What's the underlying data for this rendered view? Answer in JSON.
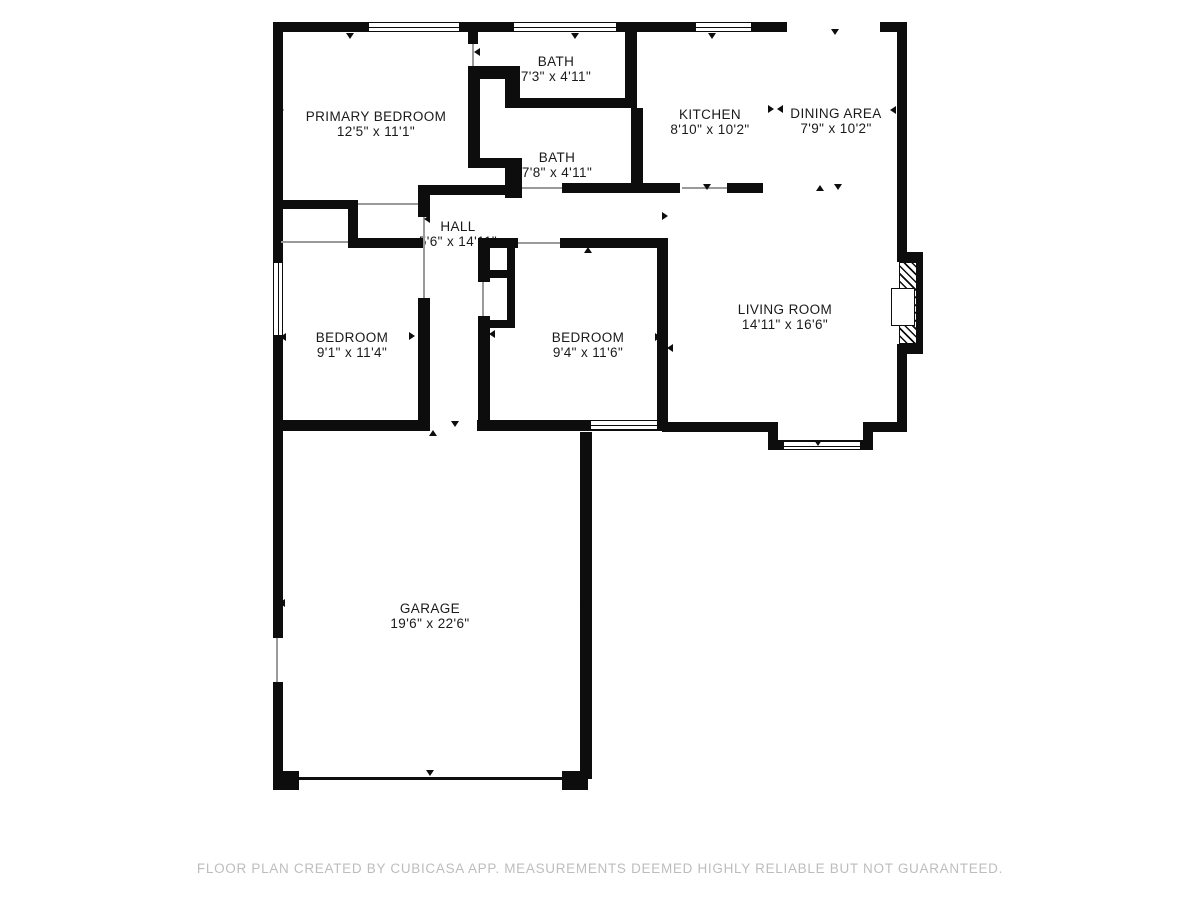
{
  "footer": {
    "text": "FLOOR PLAN CREATED BY CUBICASA APP. MEASUREMENTS DEEMED HIGHLY RELIABLE BUT NOT GUARANTEED.",
    "color": "#bdbdbd"
  },
  "floorplan": {
    "wall_color": "#0d0d0d",
    "rooms": [
      {
        "id": "primary-bedroom",
        "name": "PRIMARY BEDROOM",
        "dims": "12'5\" x 11'1\"",
        "cx": 376,
        "cy": 124
      },
      {
        "id": "bath-top",
        "name": "BATH",
        "dims": "7'3\" x 4'11\"",
        "cx": 556,
        "cy": 69
      },
      {
        "id": "bath",
        "name": "BATH",
        "dims": "7'8\" x 4'11\"",
        "cx": 557,
        "cy": 165
      },
      {
        "id": "kitchen",
        "name": "KITCHEN",
        "dims": "8'10\" x 10'2\"",
        "cx": 710,
        "cy": 122
      },
      {
        "id": "dining-area",
        "name": "DINING AREA",
        "dims": "7'9\" x 10'2\"",
        "cx": 836,
        "cy": 121
      },
      {
        "id": "hall",
        "name": "HALL",
        "dims": "5'6\" x 14'11\"",
        "cx": 458,
        "cy": 234
      },
      {
        "id": "bedroom-left",
        "name": "BEDROOM",
        "dims": "9'1\" x 11'4\"",
        "cx": 352,
        "cy": 345
      },
      {
        "id": "bedroom-middle",
        "name": "BEDROOM",
        "dims": "9'4\" x 11'6\"",
        "cx": 588,
        "cy": 345
      },
      {
        "id": "living-room",
        "name": "LIVING ROOM",
        "dims": "14'11\" x 16'6\"",
        "cx": 785,
        "cy": 317
      },
      {
        "id": "garage",
        "name": "GARAGE",
        "dims": "19'6\" x 22'6\"",
        "cx": 430,
        "cy": 616
      }
    ],
    "walls": [
      [
        273,
        22,
        514,
        10
      ],
      [
        880,
        22,
        27,
        10
      ],
      [
        897,
        22,
        10,
        240
      ],
      [
        897,
        347,
        10,
        85
      ],
      [
        273,
        22,
        10,
        616
      ],
      [
        273,
        682,
        10,
        95
      ],
      [
        273,
        771,
        26,
        19
      ],
      [
        562,
        771,
        26,
        19
      ],
      [
        283,
        777,
        281,
        3
      ],
      [
        580,
        432,
        12,
        347
      ],
      [
        283,
        420,
        147,
        11
      ],
      [
        477,
        420,
        115,
        11
      ],
      [
        580,
        420,
        88,
        11
      ],
      [
        662,
        422,
        116,
        10
      ],
      [
        768,
        422,
        10,
        28
      ],
      [
        778,
        440,
        95,
        10
      ],
      [
        863,
        422,
        10,
        28
      ],
      [
        873,
        422,
        34,
        10
      ],
      [
        897,
        252,
        26,
        10
      ],
      [
        897,
        344,
        26,
        10
      ],
      [
        915,
        252,
        8,
        102
      ],
      [
        468,
        32,
        10,
        12
      ],
      [
        468,
        66,
        50,
        13
      ],
      [
        505,
        66,
        15,
        42
      ],
      [
        505,
        98,
        125,
        10
      ],
      [
        468,
        76,
        12,
        92
      ],
      [
        468,
        158,
        50,
        10
      ],
      [
        505,
        158,
        17,
        40
      ],
      [
        625,
        32,
        12,
        76
      ],
      [
        631,
        108,
        12,
        80
      ],
      [
        562,
        183,
        118,
        10
      ],
      [
        727,
        183,
        36,
        10
      ],
      [
        428,
        185,
        94,
        10
      ],
      [
        283,
        200,
        70,
        9
      ],
      [
        348,
        200,
        10,
        48
      ],
      [
        348,
        238,
        75,
        10
      ],
      [
        418,
        185,
        12,
        32
      ],
      [
        418,
        298,
        12,
        127
      ],
      [
        478,
        238,
        40,
        10
      ],
      [
        560,
        238,
        107,
        10
      ],
      [
        657,
        238,
        11,
        190
      ],
      [
        478,
        238,
        12,
        44
      ],
      [
        478,
        316,
        12,
        112
      ],
      [
        507,
        238,
        8,
        90
      ],
      [
        478,
        270,
        37,
        8
      ],
      [
        478,
        320,
        37,
        8
      ]
    ],
    "windows": [
      {
        "x": 368,
        "y": 22,
        "w": 92,
        "h": 10,
        "o": "h"
      },
      {
        "x": 513,
        "y": 22,
        "w": 104,
        "h": 10,
        "o": "h"
      },
      {
        "x": 695,
        "y": 22,
        "w": 57,
        "h": 10,
        "o": "h"
      },
      {
        "x": 273,
        "y": 262,
        "w": 10,
        "h": 74,
        "o": "v"
      },
      {
        "x": 783,
        "y": 441,
        "w": 78,
        "h": 9,
        "o": "h"
      },
      {
        "x": 590,
        "y": 420,
        "w": 68,
        "h": 10,
        "o": "h"
      }
    ],
    "opening_lines": [
      [
        472,
        44,
        2,
        22
      ],
      [
        522,
        187,
        40,
        2
      ],
      [
        682,
        187,
        45,
        2
      ],
      [
        518,
        242,
        42,
        2
      ],
      [
        281,
        241,
        67,
        2
      ],
      [
        423,
        217,
        2,
        81
      ],
      [
        482,
        282,
        2,
        34
      ],
      [
        276,
        638,
        2,
        44
      ],
      [
        358,
        203,
        60,
        2
      ]
    ],
    "markers": [
      {
        "x": 350,
        "y": 36,
        "dir": "down"
      },
      {
        "x": 575,
        "y": 36,
        "dir": "down"
      },
      {
        "x": 712,
        "y": 36,
        "dir": "down"
      },
      {
        "x": 835,
        "y": 32,
        "dir": "down"
      },
      {
        "x": 477,
        "y": 52,
        "dir": "left"
      },
      {
        "x": 633,
        "y": 52,
        "dir": "left"
      },
      {
        "x": 635,
        "y": 150,
        "dir": "left"
      },
      {
        "x": 281,
        "y": 110,
        "dir": "right"
      },
      {
        "x": 893,
        "y": 110,
        "dir": "left"
      },
      {
        "x": 771,
        "y": 109,
        "dir": "right"
      },
      {
        "x": 780,
        "y": 109,
        "dir": "left"
      },
      {
        "x": 577,
        "y": 188,
        "dir": "down"
      },
      {
        "x": 707,
        "y": 187,
        "dir": "down"
      },
      {
        "x": 820,
        "y": 188,
        "dir": "up"
      },
      {
        "x": 838,
        "y": 187,
        "dir": "down"
      },
      {
        "x": 427,
        "y": 219,
        "dir": "left"
      },
      {
        "x": 665,
        "y": 216,
        "dir": "right"
      },
      {
        "x": 283,
        "y": 337,
        "dir": "left"
      },
      {
        "x": 412,
        "y": 336,
        "dir": "right"
      },
      {
        "x": 492,
        "y": 334,
        "dir": "left"
      },
      {
        "x": 658,
        "y": 337,
        "dir": "right"
      },
      {
        "x": 670,
        "y": 348,
        "dir": "left"
      },
      {
        "x": 588,
        "y": 250,
        "dir": "up"
      },
      {
        "x": 350,
        "y": 424,
        "dir": "down"
      },
      {
        "x": 433,
        "y": 433,
        "dir": "up"
      },
      {
        "x": 455,
        "y": 424,
        "dir": "down"
      },
      {
        "x": 583,
        "y": 603,
        "dir": "right"
      },
      {
        "x": 282,
        "y": 603,
        "dir": "left"
      },
      {
        "x": 430,
        "y": 773,
        "dir": "down"
      },
      {
        "x": 818,
        "y": 443,
        "dir": "down"
      }
    ],
    "fireplace": {
      "hatch": [
        899,
        262,
        18,
        82
      ],
      "box": [
        891,
        288,
        24,
        38
      ]
    }
  }
}
